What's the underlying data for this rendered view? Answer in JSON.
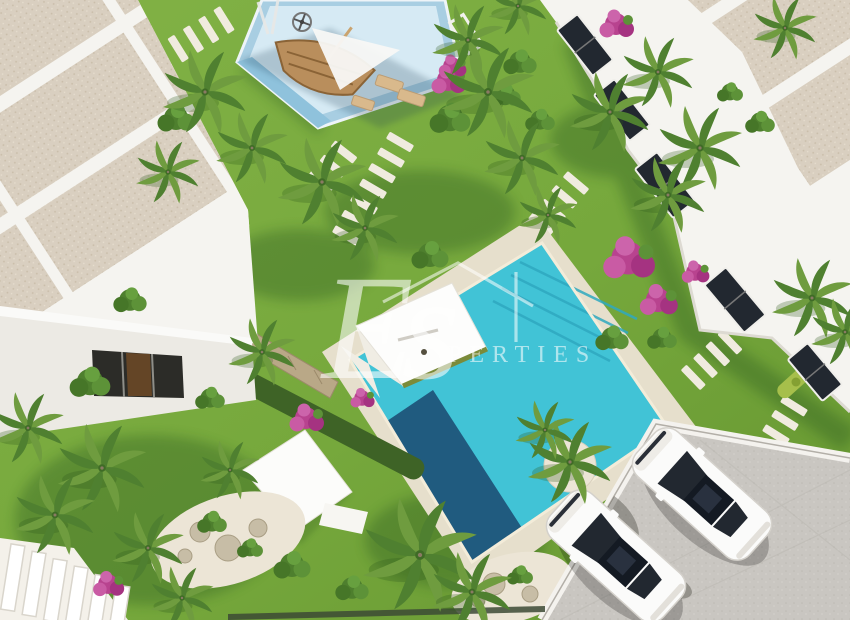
{
  "scene": {
    "type": "aerial-3d-architectural-render",
    "description": "Bird's-eye 3D visualisation of a new-build residential complex: white flat-roofed townhouses around a communal landscaped garden with palm trees, a large turquoise swimming pool with a dark deep section, a children's playground with a blue soft surface and wooden boat, white shade pavilions, stepping-stone paths, bougainvillea, rock gardens and a grey parking area with two white cars.",
    "objects": [
      "left townhouse block with gravel flat roofs",
      "right townhouse row with dark glazed windows and lime hedges",
      "communal lawn",
      "main swimming pool with steps and deep end",
      "children playground with boat play structure, spinner and shade sail",
      "two white shade pavilions",
      "stepping stone paths",
      "palm trees and bougainvillea shrubs",
      "rock gardens",
      "parking area with two white cars",
      "white exterior stairs"
    ]
  },
  "watermark": {
    "script_text": "Es",
    "text": "PERTIES"
  },
  "palette": {
    "grass1": "#7fb043",
    "grass2": "#689a31",
    "shadow": "#24511a",
    "pool": "#41c3d6",
    "pool_deep": "#1d5377",
    "pool_line": "#2fa9c0",
    "deck": "#e6dfcc",
    "coping": "#f3ecd9",
    "stone": "#f0ebdf",
    "building": "#f5f4f0",
    "wall": "#eceae4",
    "roof": "#d9cfc0",
    "roof_dot": "#c9bda9",
    "window": "#2c2c28",
    "glass": "#222830",
    "parking": "#c9c6c1",
    "hedge_lime": "#a6bf4b",
    "hedge_dark": "#3e6326",
    "palm1": "#6f9c3f",
    "palm2": "#4f8030",
    "trunk": "#8a7a63",
    "bougainvillea": "#b8438f",
    "sand": "#ece5d6",
    "rock": "#c7bda6",
    "wood": "#b98e5c",
    "play_border": "#a8cee2",
    "play_light": "#d6eaf4",
    "play_stripe": "#8fc2dc",
    "white": "#fbfbfa",
    "watermark": "#ffffff"
  }
}
